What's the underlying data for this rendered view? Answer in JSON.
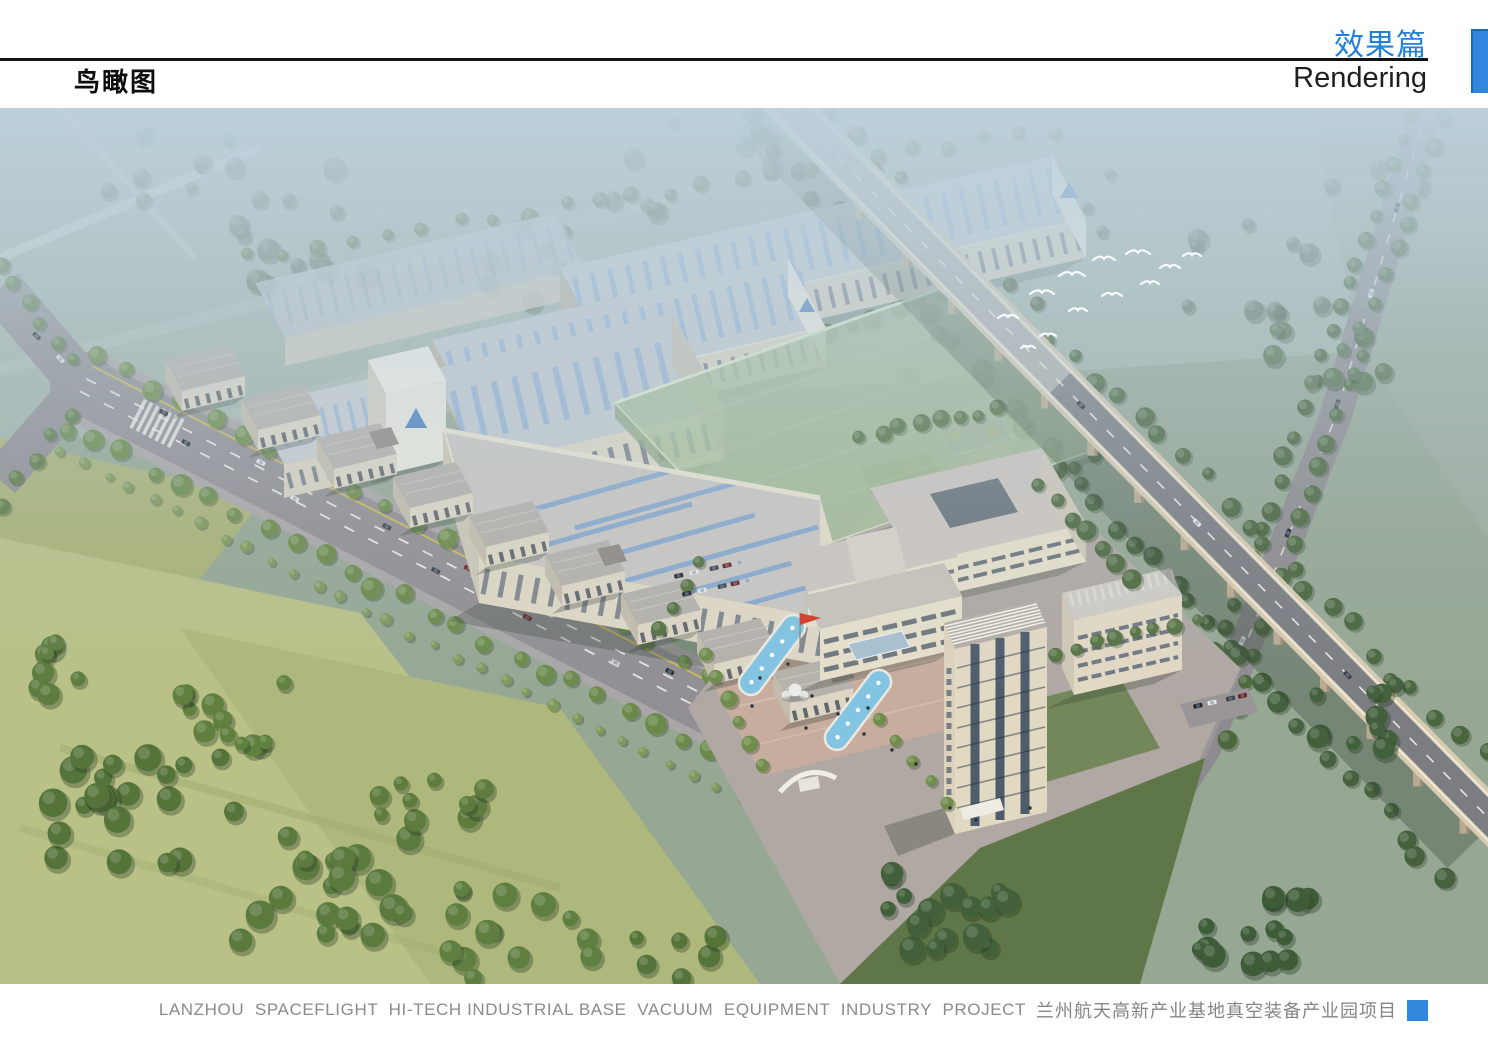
{
  "header": {
    "page_title": "鸟瞰图",
    "section_title_zh": "效果篇",
    "section_title_en": "Rendering",
    "accent_color": "#2180d8"
  },
  "footer": {
    "caption_en": "LANZHOU  SPACEFLIGHT  HI-TECH INDUSTRIAL BASE  VACUUM  EQUIPMENT  INDUSTRY  PROJECT",
    "caption_zh": "兰州航天高新产业基地真空装备产业园项目"
  },
  "rendering": {
    "palette": {
      "sky_haze": "#bfd3dc",
      "field_green": "#96a794",
      "field_warm": "#b9c187",
      "tree_green": "#55743c",
      "road_gray": "#918f93",
      "factory_roof": "#c6cbd1",
      "factory_wall": "#dbd4c2",
      "skylight_blue": "#7ea3cf",
      "massing_green": "#a8be9b",
      "plaza_paving": "#c7ad9e",
      "pool_blue": "#82c4e2",
      "flag_red": "#d23a2a",
      "logo_blue": "#4b80c2"
    }
  }
}
